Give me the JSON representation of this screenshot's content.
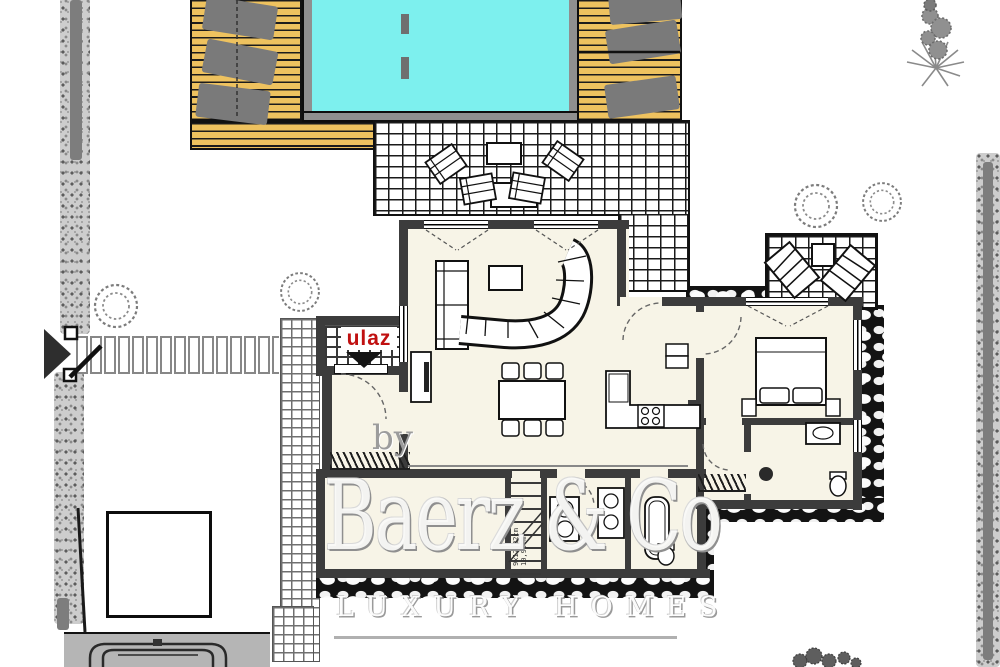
{
  "labels": {
    "entrance": "ulaz"
  },
  "watermark": {
    "prefix": "by",
    "brand": "Baerz & Co",
    "tagline": "LUXURY HOMES"
  },
  "stairs": {
    "note_dimensions": "9x17,22cm",
    "note_length": "10,90 m"
  },
  "colors": {
    "pool_water": "#7DF0EE",
    "wood_deck": "#EEC25F",
    "house_floor": "#F7F4E7",
    "wall": "#3C3C3C",
    "entrance_red": "#C01010",
    "driveway": "#B5B5B5",
    "lounger_gray": "#7A7A7A"
  }
}
